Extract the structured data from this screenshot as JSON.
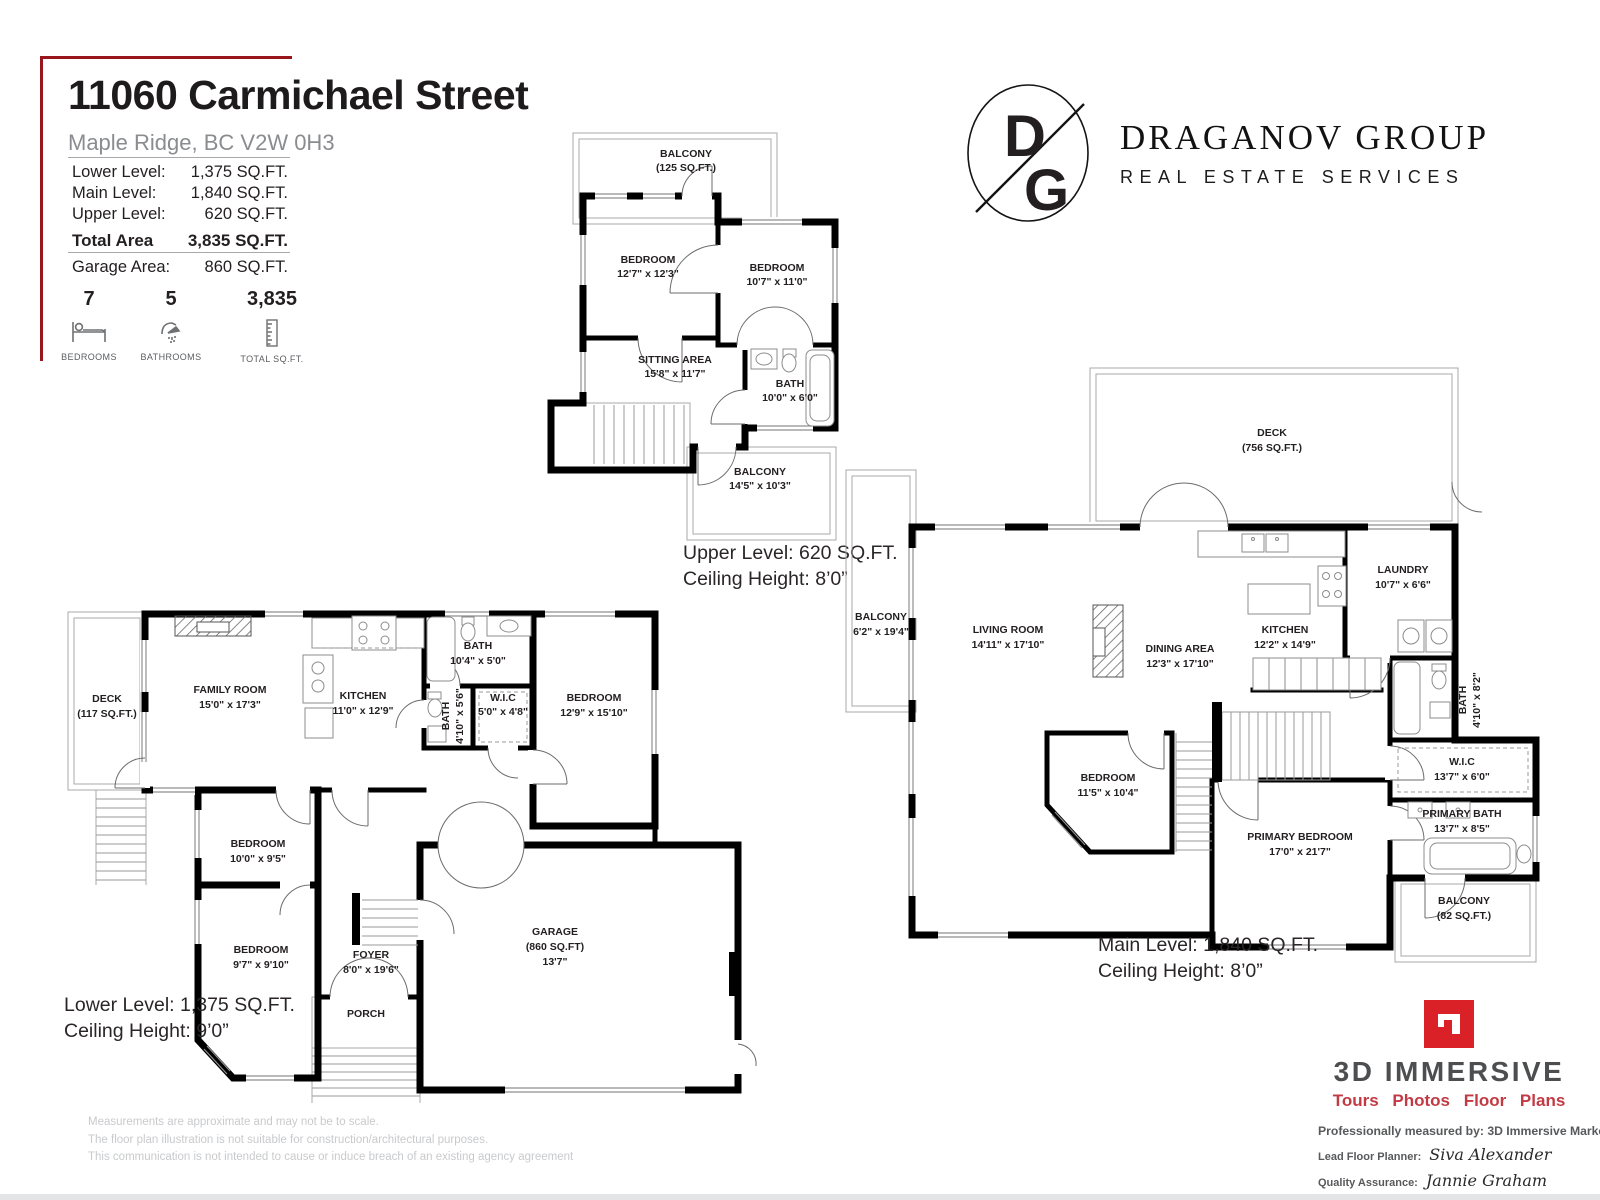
{
  "header": {
    "title": "11060 Carmichael Street",
    "subtitle": "Maple Ridge, BC V2W 0H3",
    "area_rows": [
      {
        "label": "Lower Level:",
        "value": "1,375 SQ.FT."
      },
      {
        "label": "Main Level:",
        "value": "1,840 SQ.FT."
      },
      {
        "label": "Upper Level:",
        "value": "620 SQ.FT."
      }
    ],
    "total_row": {
      "label": "Total Area",
      "value": "3,835 SQ.FT."
    },
    "garage_row": {
      "label": "Garage Area:",
      "value": "860 SQ.FT."
    },
    "stats": [
      {
        "value": "7",
        "caption": "BEDROOMS",
        "icon": "bed-icon"
      },
      {
        "value": "5",
        "caption": "BATHROOMS",
        "icon": "shower-icon"
      },
      {
        "value": "3,835",
        "caption": "TOTAL SQ.FT.",
        "icon": "ruler-icon"
      }
    ],
    "accent_color": "#9a161d"
  },
  "brand": {
    "monogram_top": "D",
    "monogram_bottom": "G",
    "name": "DRAGANOV GROUP",
    "tagline": "REAL ESTATE SERVICES"
  },
  "plans": {
    "upper": {
      "caption1": "Upper Level: 620 SQ.FT.",
      "caption2": "Ceiling Height: 8’0”",
      "rooms": {
        "balcony_top": {
          "name": "BALCONY",
          "dims": "(125 SQ.FT.)"
        },
        "bedroom1": {
          "name": "BEDROOM",
          "dims": "12'7\" x 12'3\""
        },
        "bedroom2": {
          "name": "BEDROOM",
          "dims": "10'7\" x 11'0\""
        },
        "sitting": {
          "name": "SITTING AREA",
          "dims": "15'8\" x 11'7\""
        },
        "bath": {
          "name": "BATH",
          "dims": "10'0\" x 6'0\""
        },
        "balcony_bottom": {
          "name": "BALCONY",
          "dims": "14'5\" x 10'3\""
        }
      }
    },
    "main": {
      "caption1": "Main Level: 1,840 SQ.FT.",
      "caption2": "Ceiling Height: 8’0”",
      "rooms": {
        "deck": {
          "name": "DECK",
          "dims": "(756 SQ.FT.)"
        },
        "balcony_left": {
          "name": "BALCONY",
          "dims": "6'2\" x 19'4\""
        },
        "living": {
          "name": "LIVING ROOM",
          "dims": "14'11\" x 17'10\""
        },
        "dining": {
          "name": "DINING AREA",
          "dims": "12'3\" x 17'10\""
        },
        "kitchen": {
          "name": "KITCHEN",
          "dims": "12'2\" x 14'9\""
        },
        "laundry": {
          "name": "LAUNDRY",
          "dims": "10'7\" x 6'6\""
        },
        "bath": {
          "name": "BATH",
          "dims": "4'10\" x 8'2\""
        },
        "wic": {
          "name": "W.I.C",
          "dims": "13'7\" x 6'0\""
        },
        "primary_bath": {
          "name": "PRIMARY BATH",
          "dims": "13'7\" x 8'5\""
        },
        "primary_bedroom": {
          "name": "PRIMARY BEDROOM",
          "dims": "17'0\" x 21'7\""
        },
        "bedroom": {
          "name": "BEDROOM",
          "dims": "11'5\" x 10'4\""
        },
        "balcony_br": {
          "name": "BALCONY",
          "dims": "(82 SQ.FT.)"
        }
      }
    },
    "lower": {
      "caption1": "Lower Level: 1,375 SQ.FT.",
      "caption2": "Ceiling Height: 9’0”",
      "rooms": {
        "deck": {
          "name": "DECK",
          "dims": "(117 SQ.FT.)"
        },
        "family": {
          "name": "FAMILY ROOM",
          "dims": "15'0\" x 17'3\""
        },
        "kitchen": {
          "name": "KITCHEN",
          "dims": "11'0\" x 12'9\""
        },
        "bath1": {
          "name": "BATH",
          "dims": "10'4\" x 5'0\""
        },
        "bath2": {
          "name": "BATH",
          "dims": "4'10\" x 5'6\""
        },
        "wic": {
          "name": "W.I.C",
          "dims": "5'0\" x 4'8\""
        },
        "bedroom_large": {
          "name": "BEDROOM",
          "dims": "12'9\" x 15'10\""
        },
        "bedroom_mid": {
          "name": "BEDROOM",
          "dims": "10'0\" x 9'5\""
        },
        "bedroom_small": {
          "name": "BEDROOM",
          "dims": "9'7\" x 9'10\""
        },
        "foyer": {
          "name": "FOYER",
          "dims": "8'0\" x 19'6\""
        },
        "garage": {
          "name": "GARAGE",
          "area": "(860 SQ.FT)",
          "dims": "13'7\""
        },
        "porch": {
          "name": "PORCH"
        }
      }
    }
  },
  "credits": {
    "brand_line1": "3D IMMERSIVE",
    "brand_line2": "Tours  Photos  Floor Plans",
    "measured": "Professionally measured by: 3D Immersive Marketing Ltd.",
    "planner_label": "Lead Floor Planner:",
    "planner_name": "Siva Alexander",
    "qa_label": "Quality Assurance:",
    "qa_name": "Jannie Graham"
  },
  "disclaimer": {
    "line1": "Measurements are approximate and may not be to scale.",
    "line2": "The floor plan illustration is not suitable for construction/architectural purposes.",
    "line3": "This communication is not intended to cause or induce breach of an existing agency agreement"
  }
}
